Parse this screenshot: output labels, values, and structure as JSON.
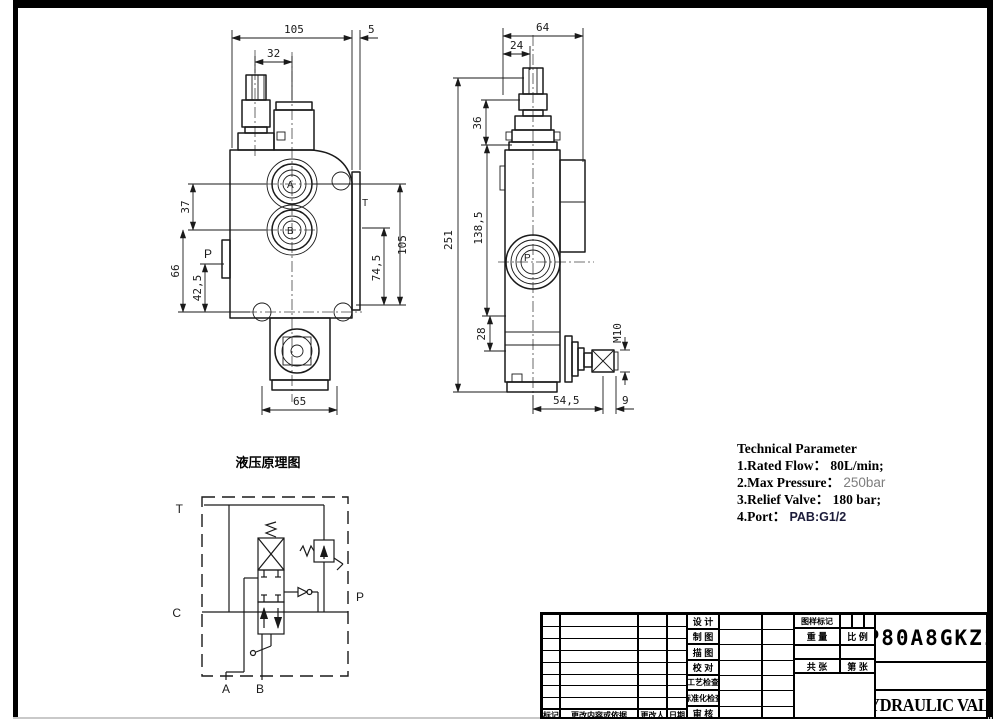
{
  "front_view": {
    "dims": {
      "top_width": "105",
      "plate_offset": "5",
      "knob_to_center": "32",
      "port_spacing": "37",
      "left_height": "66",
      "p_height": "42,5",
      "right_height": "105",
      "plate_height": "74,5",
      "bottom_width": "65"
    },
    "labels": {
      "a": "A",
      "b": "B",
      "p": "P",
      "t": "T"
    }
  },
  "side_view": {
    "dims": {
      "top_width": "64",
      "cap_width": "24",
      "knob_height": "36",
      "overall_height": "251",
      "body_height": "138,5",
      "lower_step": "28",
      "thread": "M10",
      "handle_offset": "54,5",
      "handle_end": "9"
    },
    "labels": {
      "p": "P"
    }
  },
  "schematic": {
    "title": "液压原理图",
    "labels": {
      "t": "T",
      "c": "C",
      "p": "P",
      "a": "A",
      "b": "B"
    }
  },
  "tech": {
    "title": "Technical Parameter",
    "items": [
      {
        "label": "1.Rated Flow：",
        "value": "80L/min;"
      },
      {
        "label": "2.Max Pressure：",
        "value": "250bar"
      },
      {
        "label": "3.Relief Valve：",
        "value": "180 bar;"
      },
      {
        "label": "4.Port：",
        "value": "PAB:G1/2"
      }
    ]
  },
  "title_block": {
    "part_number": "P80A8GKZ1",
    "product_name": "HYDRAULIC VALVE",
    "cells": {
      "design": "设 计",
      "draft": "制 图",
      "trace": "描 图",
      "check": "校 对",
      "process_check": "工艺检查",
      "standard_check": "标准化检查",
      "review": "审 核",
      "drawing_mark": "图样标记",
      "weight": "重 量",
      "scale": "比 例",
      "total_sheets": "共 张",
      "sheet_no": "第 张",
      "rev_mark": "标记",
      "rev_content": "更改内容或依据",
      "rev_by": "更改人",
      "rev_date": "日期"
    }
  }
}
